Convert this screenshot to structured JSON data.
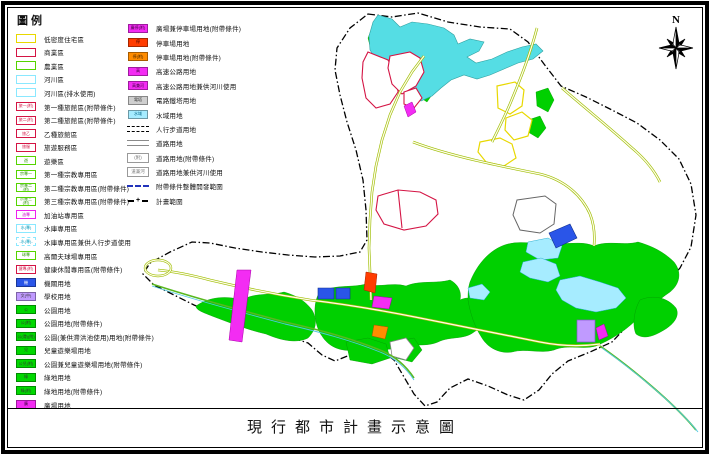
{
  "title": "現行都市計畫示意圖",
  "north_label": "N",
  "palette": {
    "residential_border": "#e8d800",
    "commercial_border": "#d41444",
    "agriculture_border": "#55d400",
    "river_border": "#8ae8ff",
    "park_fill": "#00d000",
    "government_fill": "#2a55e8",
    "school_fill": "#c09aff",
    "plaza_fill": "#f32cf3",
    "parking_fill": "#ff3c00",
    "parking_cond_fill": "#ff8c00",
    "highway_fill": "#f32cf3",
    "tower_fill": "#cfcfcf",
    "water_fill": "#a6ecff",
    "lake_fill": "#55dde4",
    "road_casing": "#9cbc00",
    "boundary_color": "#000000",
    "dev_scope_color": "#2233bb"
  },
  "legend": {
    "title": "圖例",
    "col1": [
      {
        "label": "低密度住宅區",
        "kind": "box",
        "fill": "#ffffff",
        "border": "#e8d800",
        "text": "",
        "textColor": "#b8a800"
      },
      {
        "label": "商業區",
        "kind": "box",
        "fill": "#ffffff",
        "border": "#d41444",
        "text": "",
        "textColor": "#d41444"
      },
      {
        "label": "農業區",
        "kind": "box",
        "fill": "#ffffff",
        "border": "#55d400",
        "text": "",
        "textColor": "#2a9a00"
      },
      {
        "label": "河川區",
        "kind": "box",
        "fill": "#ffffff",
        "border": "#8ae8ff",
        "text": "",
        "textColor": "#0099bb"
      },
      {
        "label": "河川區(排水使用)",
        "kind": "box",
        "fill": "#ffffff",
        "border": "#8ae8ff",
        "text": "",
        "textColor": "#0099bb"
      },
      {
        "label": "第一種旅館區(附帶條件)",
        "kind": "box",
        "fill": "#ffffff",
        "border": "#d41444",
        "text": "旅一(附)",
        "textColor": "#d41444"
      },
      {
        "label": "第二種旅館區(附帶條件)",
        "kind": "box",
        "fill": "#ffffff",
        "border": "#d41444",
        "text": "旅二(附)",
        "textColor": "#d41444"
      },
      {
        "label": "乙種旅館區",
        "kind": "box",
        "fill": "#ffffff",
        "border": "#d41444",
        "text": "旅乙",
        "textColor": "#d41444"
      },
      {
        "label": "旅遊服務區",
        "kind": "box",
        "fill": "#ffffff",
        "border": "#d41444",
        "text": "旅服",
        "textColor": "#d41444"
      },
      {
        "label": "遊樂區",
        "kind": "box",
        "fill": "#ffffff",
        "border": "#55d400",
        "text": "遊",
        "textColor": "#2a9a00"
      },
      {
        "label": "第一種宗教專用區",
        "kind": "box",
        "fill": "#ffffff",
        "border": "#55d400",
        "text": "宗專一",
        "textColor": "#2a9a00"
      },
      {
        "label": "第二種宗教專用區(附帶條件)",
        "kind": "box",
        "fill": "#ffffff",
        "border": "#55d400",
        "text": "宗專二(附)",
        "textColor": "#2a9a00"
      },
      {
        "label": "第三種宗教專用區(附帶條件)",
        "kind": "box",
        "fill": "#ffffff",
        "border": "#55d400",
        "text": "宗專三(附)",
        "textColor": "#2a9a00"
      },
      {
        "label": "加油站專用區",
        "kind": "box",
        "fill": "#ffffff",
        "border": "#ee22ee",
        "text": "油專",
        "textColor": "#cc00cc"
      },
      {
        "label": "水庫專用區",
        "kind": "box",
        "fill": "#ffffff",
        "border": "#8ae8ff",
        "text": "水(專)",
        "textColor": "#0099bb"
      },
      {
        "label": "水庫專用區兼供人行步道使用",
        "kind": "box",
        "fill": "#ffffff",
        "border": "#8ae8ff",
        "dashed": true,
        "text": "-水(專)-",
        "textColor": "#0099bb"
      },
      {
        "label": "高爾夫球場專用區",
        "kind": "box",
        "fill": "#ffffff",
        "border": "#55d400",
        "text": "球專",
        "textColor": "#2a9a00"
      },
      {
        "label": "健康休閒專用區(附帶條件)",
        "kind": "box",
        "fill": "#ffffff",
        "border": "#d41444",
        "text": "健專(附)",
        "textColor": "#d41444"
      },
      {
        "label": "機關用地",
        "kind": "box",
        "fill": "#2a55e8",
        "border": "#1a35a8",
        "text": "機",
        "textColor": "#ffffff"
      },
      {
        "label": "學校用地",
        "kind": "box",
        "fill": "#c09aff",
        "border": "#8866cc",
        "text": "文(中)",
        "textColor": "#333333"
      },
      {
        "label": "公園用地",
        "kind": "box",
        "fill": "#00d800",
        "border": "#009900",
        "text": "公",
        "textColor": "#333333"
      },
      {
        "label": "公園用地(附帶條件)",
        "kind": "box",
        "fill": "#00d800",
        "border": "#009900",
        "text": "公(附)",
        "textColor": "#333333"
      },
      {
        "label": "公園(兼供滯洪池使用)用地(附帶條件)",
        "kind": "box",
        "fill": "#00d800",
        "border": "#009900",
        "text": "公(滯)(附)",
        "textColor": "#333333"
      },
      {
        "label": "兒童遊樂場用地",
        "kind": "box",
        "fill": "#00d800",
        "border": "#009900",
        "text": "兒",
        "textColor": "#333333"
      },
      {
        "label": "公園兼兒童遊樂場用地(附帶條件)",
        "kind": "box",
        "fill": "#00d800",
        "border": "#009900",
        "text": "公兒(附)",
        "textColor": "#333333"
      },
      {
        "label": "綠地用地",
        "kind": "box",
        "fill": "#00d800",
        "border": "#009900",
        "text": "綠",
        "textColor": "#333333"
      },
      {
        "label": "綠地用地(附帶條件)",
        "kind": "box",
        "fill": "#00d800",
        "border": "#009900",
        "text": "綠(附)",
        "textColor": "#333333"
      },
      {
        "label": "廣場用地",
        "kind": "box",
        "fill": "#f32cf3",
        "border": "#aa00aa",
        "text": "廣",
        "textColor": "#330033"
      }
    ],
    "col2": [
      {
        "label": "廣場兼停車場用地(附帶條件)",
        "kind": "box",
        "fill": "#f32cf3",
        "border": "#aa00aa",
        "text": "廣停(附)",
        "textColor": "#330033"
      },
      {
        "label": "停車場用地",
        "kind": "box",
        "fill": "#ff3c00",
        "border": "#aa2200",
        "text": "停",
        "textColor": "#330000"
      },
      {
        "label": "停車場用地(附帶條件)",
        "kind": "box",
        "fill": "#ff8c00",
        "border": "#aa5500",
        "text": "停(附)",
        "textColor": "#331a00"
      },
      {
        "label": "高速公路用地",
        "kind": "box",
        "fill": "#f32cf3",
        "border": "#aa00aa",
        "text": "高",
        "textColor": "#330033"
      },
      {
        "label": "高速公路用地兼供河川使用",
        "kind": "box",
        "fill": "#f32cf3",
        "border": "#aa00aa",
        "text": "高兼河",
        "textColor": "#330033"
      },
      {
        "label": "電路鐵塔用地",
        "kind": "box",
        "fill": "#cfcfcf",
        "border": "#888888",
        "text": "電塔",
        "textColor": "#333333"
      },
      {
        "label": "水域用地",
        "kind": "box",
        "fill": "#a6ecff",
        "border": "#30b0d0",
        "text": "水域",
        "textColor": "#006688"
      },
      {
        "label": "人行步道用地",
        "kind": "line",
        "line": "walkway"
      },
      {
        "label": "道路用地",
        "kind": "line",
        "line": "road"
      },
      {
        "label": "道路用地(附帶條件)",
        "kind": "line",
        "line": "road-cond",
        "text": "(附)"
      },
      {
        "label": "道路用地兼供河川使用",
        "kind": "line",
        "line": "road-river",
        "text": "道兼河"
      },
      {
        "label": "附帶條件整體開發範圍",
        "kind": "line",
        "line": "blue-dash"
      },
      {
        "label": "計畫範圍",
        "kind": "line",
        "line": "plan-boundary"
      }
    ]
  }
}
